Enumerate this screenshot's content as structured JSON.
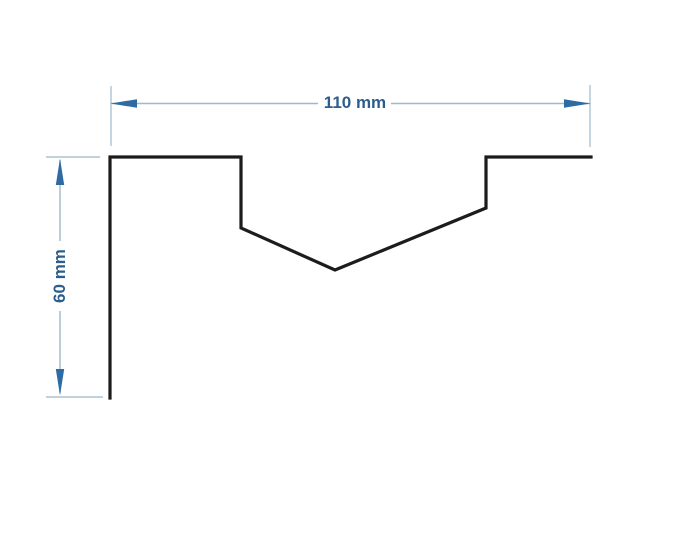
{
  "drawing": {
    "background_color": "#ffffff",
    "profile": {
      "stroke_color": "#1c1c1c",
      "points": "110,398 110,157 241,157 241,228 335,270 486,208 486,157 591,157"
    },
    "dimensions": {
      "horizontal": {
        "label": "110 mm",
        "value": 110,
        "unit": "mm"
      },
      "vertical": {
        "label": "60 mm",
        "value": 60,
        "unit": "mm"
      }
    },
    "colors": {
      "dimension_line": "#9fb9ca",
      "extension_line": "#aec3d2",
      "arrow": "#2e6ba3",
      "label_text": "#2c5d8d"
    }
  }
}
